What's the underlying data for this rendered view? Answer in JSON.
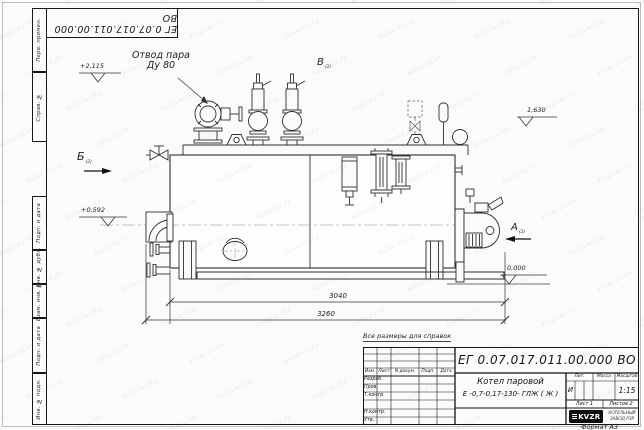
{
  "sheet": {
    "format_label": "Формат А3",
    "reference_note": "Все размеры для справок",
    "top_stamp": "ЕГ 0.07.017.011.00.000  ВО"
  },
  "side_columns": [
    "Перв. примен.",
    "Справ. №",
    "Подп. и дата",
    "Инв. № дубл.",
    "Взам. инв. №",
    "Подп. и дата",
    "Инв. № подл."
  ],
  "title_block": {
    "designation": "ЕГ 0.07.017.011.00.000  ВО",
    "product_line1": "Котел паровой",
    "product_line2": "Е -0,7-0,17-130- ГЛЖ ( Ж )",
    "header_cells": [
      "Изм.",
      "Лист",
      "N докум.",
      "Подп.",
      "Дата"
    ],
    "signature_rows": [
      "Разраб.",
      "Пров.",
      "Т.контр.",
      "",
      "Н.контр.",
      "Утв."
    ],
    "lit_label": "Лит.",
    "lit_value": "И",
    "mass_label": "Масса",
    "mass_value": "",
    "scale_label": "Масштаб",
    "scale_value": "1:15",
    "sheet_cell": "Лист 1",
    "sheets_cell": "Листов 2",
    "logo_text": "KVZR",
    "company_line1": "КОТЕЛЬНЫЙ",
    "company_line2": "ЗАВОД РЗР"
  },
  "annotations": {
    "steam_outlet_line1": "Отвод пара",
    "steam_outlet_line2": "Ду 80",
    "elevation_top": "+2,115",
    "elevation_left": "+0,592",
    "elevation_right": "1,630",
    "elevation_zero": "0,000",
    "view_a": "А",
    "view_b": "Б",
    "view_v": "В",
    "view_sheet_ref": "(2)"
  },
  "dimensions": {
    "shell_length": "3040",
    "overall_length": "3260"
  },
  "watermark": {
    "text": "kotel-kv.kz"
  },
  "colors": {
    "watermark": "rgba(125,125,125,0.15)"
  }
}
